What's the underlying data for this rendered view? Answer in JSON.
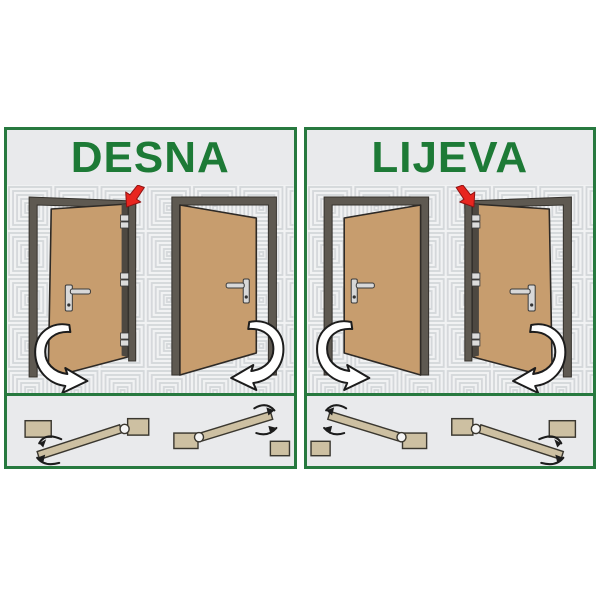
{
  "infographic": {
    "panels": [
      {
        "id": "desna",
        "title": "DESNA"
      },
      {
        "id": "lijeva",
        "title": "LIJEVA"
      }
    ]
  },
  "icons": {
    "hinge_arrow": "red-arrow-pointing-at-hinge-side",
    "swing_arrow": "white-curved-door-swing-arrow",
    "plan_swing_hooks": "black-curved-swing-direction-arrows",
    "plan_hinge": "hinge-pivot-circle"
  },
  "colors": {
    "panel_border": "#27793f",
    "title_green": "#1d7a36",
    "band_bg": "#e9eaec",
    "pattern_bg": "#f1f2f3",
    "pattern_line": "#d4d7da",
    "door_leaf": "#c79d6e",
    "door_frame": "#5e5951",
    "plan_wood": "#cdc0a2",
    "arrow_red": "#e8251f"
  }
}
